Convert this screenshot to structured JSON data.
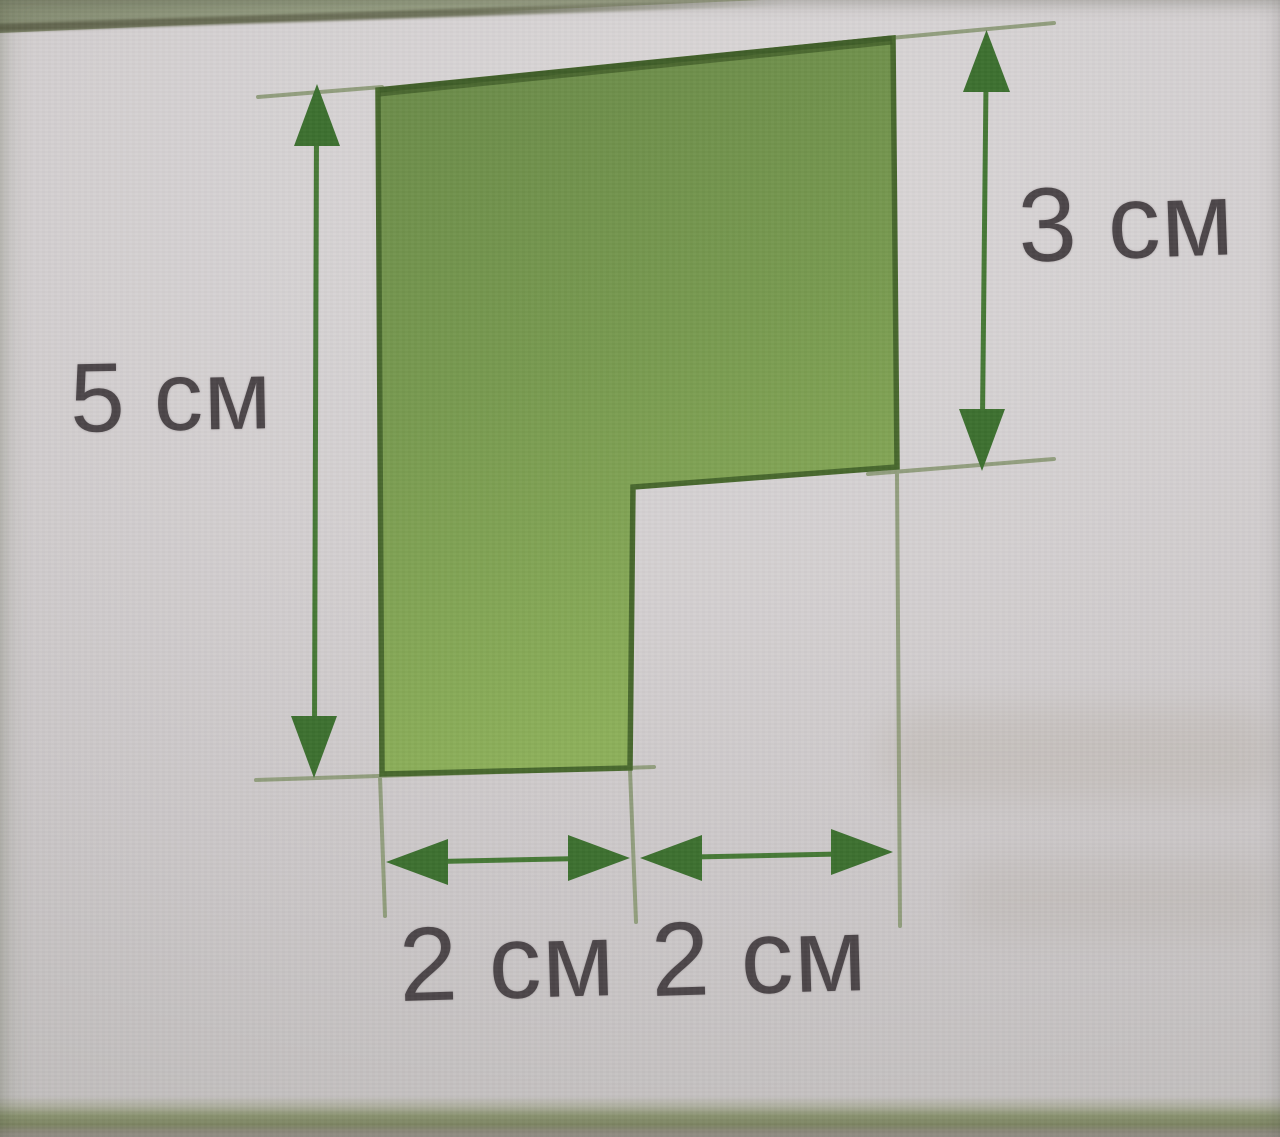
{
  "figure": {
    "kind": "geometry-diagram",
    "shape": "step-polygon",
    "labels": {
      "left_height": "5 см",
      "right_height": "3 см",
      "bottom_left_width": "2 см",
      "bottom_right_width": "2 см"
    },
    "values": {
      "left_height_cm": 5,
      "right_height_cm": 3,
      "bottom_left_width_cm": 2,
      "bottom_right_width_cm": 2
    },
    "unit": "см",
    "colors": {
      "shape_fill_top": "#6a8a49",
      "shape_fill_bottom": "#8db05a",
      "shape_outline": "#48682e",
      "arrow_line": "#467936",
      "arrow_head": "#3d7030",
      "extension_line": "#8f9c7a",
      "label_text": "#4c4649",
      "paper": "#d2cecf",
      "page_edge_band": "#7d8563",
      "top_wedge": "#9ba387"
    }
  }
}
